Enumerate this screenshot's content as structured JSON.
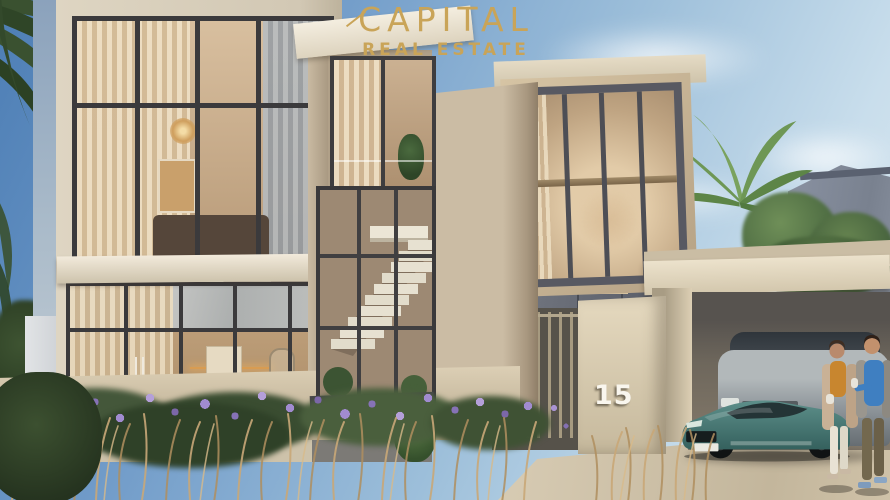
{
  "watermark": {
    "brand": "CAPITAL",
    "tagline": "REAL ESTATE",
    "color": "#c9a458"
  },
  "property": {
    "house_number": "15"
  },
  "scene": {
    "setting": "modern villa exterior render",
    "visible_elements": [
      "two-storey glass facade with curtains",
      "central staircase atrium",
      "concrete walls",
      "carport with teal sports car and grey SUV",
      "couple walking with coffee",
      "purple flower bed with dry grasses",
      "palm trees",
      "neighbouring house",
      "blue sky with light clouds"
    ]
  },
  "palette": {
    "sky_top": "#4d7eb5",
    "sky_bottom": "#dde9f1",
    "facade_cream": "#d8cfbc",
    "concrete_beige": "#c9baa2",
    "wall_gray": "#666a74",
    "window_frame": "#3b3a3c",
    "interior_warm": "#c4a57f",
    "car_teal": "#4c7e7b",
    "flowers_purple": "#9c86cb",
    "grass_tan": "#c9a878",
    "gold": "#c9a458"
  }
}
